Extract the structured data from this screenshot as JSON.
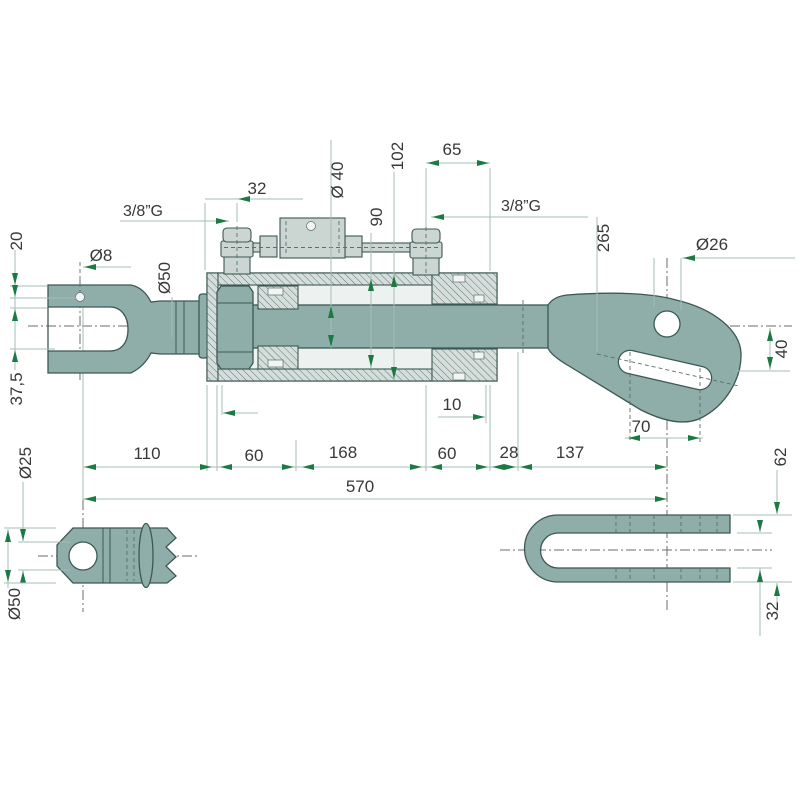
{
  "drawing": {
    "labels": {
      "dim_20": "20",
      "dia_8": "Ø8",
      "dim_37_5": "37,5",
      "dia_50_top": "Ø50",
      "port_left": "3/8”G",
      "dim_32_top": "32",
      "dia_40": "Ø 40",
      "dim_90": "90",
      "dim_102": "102",
      "dim_65": "65",
      "port_right": "3/8”G",
      "dim_265": "265",
      "dia_26": "Ø26",
      "dim_40_right": "40",
      "dim_10": "10",
      "dim_70": "70",
      "dim_110": "110",
      "dim_60_a": "60",
      "dim_168": "168",
      "dim_60_b": "60",
      "dim_28": "28",
      "dim_137": "137",
      "dim_570": "570",
      "dim_62": "62",
      "dim_32_right": "32",
      "dia_25": "Ø25",
      "dia_50_bottom": "Ø50"
    },
    "colors": {
      "part_fill": "#8FAEAA",
      "part_stroke": "#3D5854",
      "fitting_fill": "#CBD6D3",
      "hatch_bg": "#D5DEDB",
      "dim_arrow_green": "#1B7A44",
      "dim_line": "#A6BCB6",
      "text": "#383838",
      "centerline": "#6B6B6B",
      "background": "#FFFFFF"
    }
  }
}
